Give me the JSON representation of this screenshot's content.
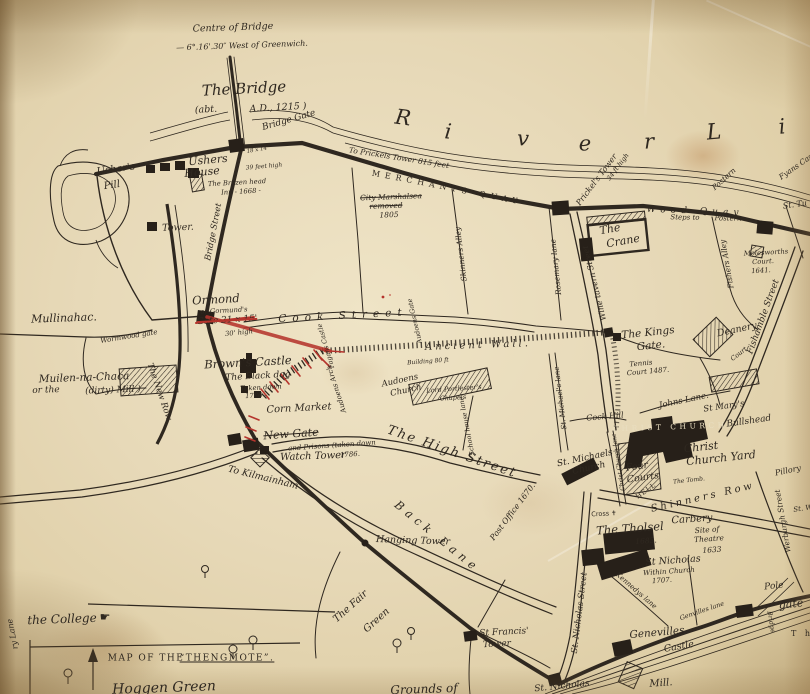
{
  "palette": {
    "paper": "#e7d9b8",
    "ink": "#2f2820",
    "red": "#b5342c",
    "knockout": "#e9dec0"
  },
  "labels": [
    {
      "n": "centre-of-bridge-note",
      "t": "Centre of Bridge",
      "x": 233,
      "y": 28,
      "s": 9.5,
      "r": -2
    },
    {
      "n": "greenwich-note",
      "t": "— 6°.16'.30″ West of Greenwich.",
      "x": 242,
      "y": 46,
      "s": 8,
      "r": -2
    },
    {
      "n": "the-bridge",
      "t": "The Bridge",
      "x": 244,
      "y": 89,
      "s": 15,
      "r": -3
    },
    {
      "n": "bridge-date-left",
      "t": "(abt.",
      "x": 206,
      "y": 110,
      "s": 9.5,
      "r": -3
    },
    {
      "n": "bridge-date-right",
      "t": "A.D., 1215 )",
      "x": 278,
      "y": 108,
      "s": 9.5,
      "r": -3
    },
    {
      "n": "bridge-gate",
      "t": "Bridge Gate",
      "x": 289,
      "y": 121,
      "s": 9,
      "r": -16
    },
    {
      "n": "bridge-gate-size",
      "t": "18 x 14",
      "x": 257,
      "y": 151,
      "s": 5.5,
      "r": -10
    },
    {
      "n": "bridge-gate-height",
      "t": "39 feet high",
      "x": 264,
      "y": 167,
      "s": 6,
      "r": -5
    },
    {
      "n": "river-letter-1",
      "t": "R",
      "x": 403,
      "y": 118,
      "s": 21,
      "r": 8
    },
    {
      "n": "river-letter-2",
      "t": "i",
      "x": 448,
      "y": 132,
      "s": 21,
      "r": 6
    },
    {
      "n": "river-letter-3",
      "t": "v",
      "x": 523,
      "y": 139,
      "s": 21,
      "r": 3
    },
    {
      "n": "river-letter-4",
      "t": "e",
      "x": 585,
      "y": 144,
      "s": 21,
      "r": 0
    },
    {
      "n": "river-letter-5",
      "t": "r",
      "x": 649,
      "y": 142,
      "s": 21,
      "r": -2
    },
    {
      "n": "river-letter-6",
      "t": "L",
      "x": 714,
      "y": 133,
      "s": 22,
      "r": -5
    },
    {
      "n": "river-letter-7",
      "t": "i",
      "x": 782,
      "y": 127,
      "s": 21,
      "r": -6
    },
    {
      "n": "to-prickels-tower-note",
      "t": "To Prickels Tower 815 feet",
      "x": 399,
      "y": 158,
      "s": 7.5,
      "r": 9
    },
    {
      "n": "merchants-quay",
      "t": "MERCHANTS QUAY",
      "x": 447,
      "y": 188,
      "s": 8,
      "r": 11,
      "ls": 5,
      "cls": "caps"
    },
    {
      "n": "city-marshalsea-1",
      "t": "City Marshalsea",
      "x": 391,
      "y": 197,
      "s": 7.5,
      "r": -2,
      "td": "strike"
    },
    {
      "n": "city-marshalsea-2",
      "t": "removed",
      "x": 386,
      "y": 206,
      "s": 7.5,
      "r": -2,
      "td": "strike"
    },
    {
      "n": "city-marshalsea-3",
      "t": "1805",
      "x": 389,
      "y": 215,
      "s": 7.5,
      "r": -2
    },
    {
      "n": "prickels-tower",
      "t": "Prickel's Tower",
      "x": 597,
      "y": 180,
      "s": 8,
      "r": -53
    },
    {
      "n": "prickels-tower-height",
      "t": "34 ft high",
      "x": 618,
      "y": 167,
      "s": 6.5,
      "r": -53
    },
    {
      "n": "postern-northeast",
      "t": "Postern",
      "x": 724,
      "y": 179,
      "s": 7.5,
      "r": -42
    },
    {
      "n": "fyans-castle",
      "t": "Fyans Cast",
      "x": 797,
      "y": 166,
      "s": 7.5,
      "r": -35
    },
    {
      "n": "wood-quay",
      "t": "Wood Quay",
      "x": 695,
      "y": 212,
      "s": 9,
      "r": 2,
      "ls": 5
    },
    {
      "n": "steps-to-postern-1",
      "t": "Steps to",
      "x": 685,
      "y": 218,
      "s": 7,
      "r": 1
    },
    {
      "n": "steps-to-postern-2",
      "t": "Postern",
      "x": 728,
      "y": 219,
      "s": 7,
      "r": 1
    },
    {
      "n": "st-tullocks-fragment",
      "t": "St. Tu",
      "x": 795,
      "y": 205,
      "s": 8,
      "r": -8
    },
    {
      "n": "the-crane-1",
      "t": "The",
      "x": 610,
      "y": 229,
      "s": 11,
      "r": -10
    },
    {
      "n": "the-crane-2",
      "t": "Crane",
      "x": 623,
      "y": 241,
      "s": 11,
      "r": -10
    },
    {
      "n": "molesworths-court-1",
      "t": "Molesworths",
      "x": 766,
      "y": 253,
      "s": 6.8,
      "r": -3
    },
    {
      "n": "molesworths-court-2",
      "t": "Court.",
      "x": 763,
      "y": 262,
      "s": 6.8,
      "r": -3
    },
    {
      "n": "molesworths-court-3",
      "t": "1641.",
      "x": 761,
      "y": 271,
      "s": 6.8,
      "r": -3
    },
    {
      "n": "fishers-alley",
      "t": "Fishers Alley",
      "x": 727,
      "y": 264,
      "s": 7.5,
      "r": -100
    },
    {
      "n": "wine-tavern-street",
      "t": "Wine tavern Street",
      "x": 595,
      "y": 283,
      "s": 8,
      "r": -104
    },
    {
      "n": "rosemary-lane",
      "t": "Rosemary lane",
      "x": 556,
      "y": 267,
      "s": 7.5,
      "r": -96
    },
    {
      "n": "skinners-alley",
      "t": "Skinners Alley",
      "x": 461,
      "y": 254,
      "s": 7.5,
      "r": -97
    },
    {
      "n": "ushers-pill-1",
      "t": "Usher's",
      "x": 116,
      "y": 170,
      "s": 10,
      "r": -8
    },
    {
      "n": "ushers-pill-2",
      "t": "Pill",
      "x": 112,
      "y": 186,
      "s": 10,
      "r": -8
    },
    {
      "n": "ushers-house-1",
      "t": "Ushers",
      "x": 208,
      "y": 160,
      "s": 11,
      "r": -5
    },
    {
      "n": "ushers-house-2",
      "t": "House",
      "x": 202,
      "y": 172,
      "s": 11,
      "r": -5
    },
    {
      "n": "brazen-head-1",
      "t": "The Brazen head",
      "x": 237,
      "y": 183,
      "s": 6.8,
      "r": -3
    },
    {
      "n": "brazen-head-2",
      "t": "Inn - 1668 -",
      "x": 241,
      "y": 192,
      "s": 6.8,
      "r": -3
    },
    {
      "n": "tower",
      "t": "Tower.",
      "x": 178,
      "y": 228,
      "s": 9.5,
      "r": -2
    },
    {
      "n": "bridge-street",
      "t": "Bridge Street",
      "x": 214,
      "y": 232,
      "s": 8.5,
      "r": -79
    },
    {
      "n": "mullinahac",
      "t": "Mullinahac.",
      "x": 64,
      "y": 318,
      "s": 11,
      "r": -2
    },
    {
      "n": "wormwood-gate",
      "t": "Wormwood gate",
      "x": 129,
      "y": 337,
      "s": 7,
      "r": -9
    },
    {
      "n": "ormond-gate-1",
      "t": "Ormond",
      "x": 216,
      "y": 300,
      "s": 11.5,
      "r": -3
    },
    {
      "n": "ormond-gate-2",
      "t": "or Gormund's",
      "x": 224,
      "y": 311,
      "s": 6.8,
      "r": -3
    },
    {
      "n": "ormond-gate-3",
      "t": "Gate 21 x 15'",
      "x": 227,
      "y": 321,
      "s": 9,
      "r": -3,
      "td": "strike-red"
    },
    {
      "n": "ormond-gate-4",
      "t": "30' high",
      "x": 239,
      "y": 333,
      "s": 6.8,
      "r": -6
    },
    {
      "n": "muilen-na-chaca-1",
      "t": "Muilen-na-Chaca",
      "x": 84,
      "y": 378,
      "s": 10.5,
      "r": -2
    },
    {
      "n": "muilen-na-chaca-2",
      "t": "or the",
      "x": 46,
      "y": 391,
      "s": 9,
      "r": -2
    },
    {
      "n": "muilen-na-chaca-3",
      "t": "(dirty) Mill )",
      "x": 113,
      "y": 391,
      "s": 9,
      "r": -2
    },
    {
      "n": "the-new-row",
      "t": "The New Row",
      "x": 159,
      "y": 392,
      "s": 8.5,
      "r": 71
    },
    {
      "n": "browns-castle",
      "t": "Brown's Castle",
      "x": 248,
      "y": 363,
      "s": 11.5,
      "r": -3
    },
    {
      "n": "black-dog-1",
      "t": "The Black dog",
      "x": 258,
      "y": 377,
      "s": 9,
      "r": -3
    },
    {
      "n": "black-dog-2",
      "t": "Taken down",
      "x": 261,
      "y": 388,
      "s": 6.8,
      "r": -3
    },
    {
      "n": "black-dog-3",
      "t": "1786 -",
      "x": 256,
      "y": 396,
      "s": 6.8,
      "r": -3
    },
    {
      "n": "corn-market",
      "t": "Corn Market",
      "x": 299,
      "y": 409,
      "s": 10,
      "r": -3
    },
    {
      "n": "new-gate-1",
      "t": "New Gate",
      "x": 291,
      "y": 434,
      "s": 11,
      "r": -4,
      "td": "strike"
    },
    {
      "n": "new-gate-2",
      "t": "and Prisons (taken down",
      "x": 332,
      "y": 446,
      "s": 7,
      "r": -4
    },
    {
      "n": "new-gate-3",
      "t": "1786.",
      "x": 350,
      "y": 455,
      "s": 7,
      "r": -4
    },
    {
      "n": "watch-tower",
      "t": "Watch Tower",
      "x": 313,
      "y": 457,
      "s": 10,
      "r": -2
    },
    {
      "n": "to-kilmainham",
      "t": "To Kilmainham",
      "x": 263,
      "y": 478,
      "s": 9.5,
      "r": 14
    },
    {
      "n": "cook-street",
      "t": "Cook Street",
      "x": 343,
      "y": 316,
      "s": 10.5,
      "r": -3,
      "ls": 6
    },
    {
      "n": "ancient-wall",
      "t": "Ancient Wall.",
      "x": 478,
      "y": 346,
      "s": 10,
      "r": -2,
      "ls": 3
    },
    {
      "n": "fagans-castle",
      "t": "Fagans Castle",
      "x": 326,
      "y": 346,
      "s": 6.5,
      "r": -106
    },
    {
      "n": "audoens-gate",
      "t": "Audoens Gate",
      "x": 415,
      "y": 321,
      "s": 6.5,
      "r": -103
    },
    {
      "n": "audoens-arch",
      "t": "Audoens Arch",
      "x": 337,
      "y": 389,
      "s": 7,
      "r": -108
    },
    {
      "n": "building-note",
      "t": "Building 80 ft",
      "x": 428,
      "y": 362,
      "s": 6,
      "r": -4
    },
    {
      "n": "audoens-church-1",
      "t": "Audoens",
      "x": 400,
      "y": 381,
      "s": 8.5,
      "r": -12
    },
    {
      "n": "audoens-church-2",
      "t": "Church",
      "x": 406,
      "y": 391,
      "s": 8.5,
      "r": -12
    },
    {
      "n": "portlesters-chapel-1",
      "t": "Lord Portlester's",
      "x": 454,
      "y": 389,
      "s": 6.5,
      "r": -4
    },
    {
      "n": "portlesters-chapel-2",
      "t": "Chapels",
      "x": 453,
      "y": 398,
      "s": 6.5,
      "r": -4
    },
    {
      "n": "school-house-lane",
      "t": "School house lane",
      "x": 467,
      "y": 426,
      "s": 6.5,
      "r": -101
    },
    {
      "n": "the-high-street",
      "t": "The High Street",
      "x": 452,
      "y": 452,
      "s": 13,
      "r": 19,
      "ls": 2
    },
    {
      "n": "back-lane",
      "t": "Back Lane",
      "x": 437,
      "y": 537,
      "s": 11.5,
      "r": 39,
      "ls": 5
    },
    {
      "n": "hanging-tower",
      "t": "Hanging Tower",
      "x": 413,
      "y": 541,
      "s": 9.5,
      "r": 2
    },
    {
      "n": "post-office",
      "t": "Post Office 1670.",
      "x": 513,
      "y": 512,
      "s": 8,
      "r": -53
    },
    {
      "n": "fair-green-1",
      "t": "The Fair",
      "x": 351,
      "y": 607,
      "s": 10,
      "r": -42
    },
    {
      "n": "fair-green-2",
      "t": "Green",
      "x": 377,
      "y": 621,
      "s": 10,
      "r": -42
    },
    {
      "n": "st-francis-tower-1",
      "t": "St Francis'",
      "x": 504,
      "y": 633,
      "s": 9,
      "r": -3
    },
    {
      "n": "st-francis-tower-2",
      "t": "Tower",
      "x": 497,
      "y": 645,
      "s": 9,
      "r": -3
    },
    {
      "n": "grounds-of",
      "t": "Grounds of",
      "x": 424,
      "y": 689,
      "s": 12,
      "r": -2
    },
    {
      "n": "st-nicholas-gate",
      "t": "St. Nicholas",
      "x": 562,
      "y": 687,
      "s": 9,
      "r": -6
    },
    {
      "n": "st-nicholas-street",
      "t": "St. Nicholas Street",
      "x": 580,
      "y": 613,
      "s": 8.5,
      "r": -83
    },
    {
      "n": "kennedys-lane",
      "t": "Kennedys lane",
      "x": 636,
      "y": 591,
      "s": 7,
      "r": 41
    },
    {
      "n": "st-nicholas-church-1",
      "t": "St Nicholas",
      "x": 673,
      "y": 561,
      "s": 9.5,
      "r": -4
    },
    {
      "n": "st-nicholas-church-2",
      "t": "Within Church",
      "x": 669,
      "y": 572,
      "s": 7,
      "r": -4
    },
    {
      "n": "st-nicholas-church-3",
      "t": "1707.",
      "x": 662,
      "y": 581,
      "s": 7,
      "r": -4
    },
    {
      "n": "genevilles-castle-1",
      "t": "Genevilles",
      "x": 657,
      "y": 633,
      "s": 10.5,
      "r": -5
    },
    {
      "n": "genevilles-castle-2",
      "t": "Castle",
      "x": 679,
      "y": 647,
      "s": 9.5,
      "r": -10
    },
    {
      "n": "genvilles-lane",
      "t": "Genvilles lane",
      "x": 702,
      "y": 611,
      "s": 6.5,
      "r": -19
    },
    {
      "n": "pole-gate-1",
      "t": "Pole",
      "x": 774,
      "y": 587,
      "s": 9,
      "r": -6
    },
    {
      "n": "pole-gate-2",
      "t": "gate",
      "x": 791,
      "y": 604,
      "s": 11,
      "r": -6
    },
    {
      "n": "pole-gate-bridge",
      "t": "Bridge",
      "x": 771,
      "y": 622,
      "s": 6.5,
      "r": 80
    },
    {
      "n": "t-h-fragment",
      "t": "T h",
      "x": 802,
      "y": 634,
      "s": 8,
      "r": 0,
      "ls": 3,
      "cls": "caps"
    },
    {
      "n": "mill",
      "t": "Mill.",
      "x": 661,
      "y": 684,
      "s": 10,
      "r": -4
    },
    {
      "n": "the-kings-gate-1",
      "t": "The Kings",
      "x": 648,
      "y": 333,
      "s": 10.5,
      "r": -6
    },
    {
      "n": "the-kings-gate-2",
      "t": "Gate.",
      "x": 651,
      "y": 346,
      "s": 10.5,
      "r": -6
    },
    {
      "n": "deanery",
      "t": "Deanery",
      "x": 737,
      "y": 330,
      "s": 9.5,
      "r": -12
    },
    {
      "n": "deanery-court",
      "t": "Court",
      "x": 739,
      "y": 354,
      "s": 6.5,
      "r": -38
    },
    {
      "n": "fishamble-street",
      "t": "Fishamble Street",
      "x": 764,
      "y": 317,
      "s": 9,
      "r": -70
    },
    {
      "n": "tennis-court-1",
      "t": "Tennis",
      "x": 641,
      "y": 364,
      "s": 7,
      "r": -5
    },
    {
      "n": "tennis-court-2",
      "t": "Court 1487.",
      "x": 648,
      "y": 372,
      "s": 7,
      "r": -5
    },
    {
      "n": "johns-lane",
      "t": "Johns Lane.",
      "x": 684,
      "y": 401,
      "s": 8.5,
      "r": -12
    },
    {
      "n": "st-marys",
      "t": "St Mary's",
      "x": 724,
      "y": 407,
      "s": 8.5,
      "r": -8
    },
    {
      "n": "christ-church-caps",
      "t": "CHRIST CHURCH.",
      "x": 673,
      "y": 427,
      "s": 7.5,
      "r": -2,
      "ls": 3.5,
      "cls": "caps",
      "c": "#e9dec0"
    },
    {
      "n": "bullshead",
      "t": "Bullshead",
      "x": 749,
      "y": 422,
      "s": 9,
      "r": -8
    },
    {
      "n": "christ-church-yard-1",
      "t": "Christ",
      "x": 701,
      "y": 447,
      "s": 11,
      "r": -6
    },
    {
      "n": "christ-church-yard-2",
      "t": "Church Yard",
      "x": 721,
      "y": 458,
      "s": 11,
      "r": -6
    },
    {
      "n": "the-tomb",
      "t": "The Tomb.",
      "x": 689,
      "y": 481,
      "s": 6,
      "r": -6
    },
    {
      "n": "st-michaels-church-1",
      "t": "St. Michaels",
      "x": 585,
      "y": 459,
      "s": 9,
      "r": -12
    },
    {
      "n": "st-michaels-church-2",
      "t": "Church",
      "x": 589,
      "y": 469,
      "s": 9,
      "r": -12
    },
    {
      "n": "four-courts-1",
      "t": "Four",
      "x": 637,
      "y": 467,
      "s": 9.5,
      "r": -8
    },
    {
      "n": "four-courts-2",
      "t": "Courts",
      "x": 643,
      "y": 478,
      "s": 9.5,
      "r": -8
    },
    {
      "n": "cock-hill",
      "t": "Cock Hill",
      "x": 605,
      "y": 417,
      "s": 8,
      "r": -5
    },
    {
      "n": "st-michaels-lane",
      "t": "St. Michael's lane",
      "x": 561,
      "y": 398,
      "s": 7,
      "r": -97
    },
    {
      "n": "christ-church-lane",
      "t": "Christ Church lane",
      "x": 619,
      "y": 462,
      "s": 6,
      "r": -99
    },
    {
      "n": "hell",
      "t": "HELL",
      "x": 646,
      "y": 491,
      "s": 6.5,
      "r": -35,
      "ls": 1,
      "cls": "caps"
    },
    {
      "n": "shinners-row",
      "t": "Shinners Row",
      "x": 703,
      "y": 498,
      "s": 10,
      "r": -13,
      "ls": 3
    },
    {
      "n": "cross-marker",
      "t": "Cross ✝",
      "x": 604,
      "y": 514,
      "s": 6.5,
      "r": -3,
      "cls": "glyph"
    },
    {
      "n": "pillory",
      "t": "Pillory",
      "x": 788,
      "y": 471,
      "s": 8,
      "r": -12
    },
    {
      "n": "werburgh-street",
      "t": "Werburgh Street",
      "x": 783,
      "y": 521,
      "s": 7.5,
      "r": -100
    },
    {
      "n": "st-w-fragment",
      "t": "St. W",
      "x": 803,
      "y": 509,
      "s": 7,
      "r": -8
    },
    {
      "n": "the-tholsel",
      "t": "The Tholsel",
      "x": 630,
      "y": 529,
      "s": 11.5,
      "r": -4
    },
    {
      "n": "tholsel-date",
      "t": "1683.",
      "x": 646,
      "y": 541,
      "s": 7.5,
      "r": -4
    },
    {
      "n": "carbery",
      "t": "Carbery",
      "x": 692,
      "y": 520,
      "s": 10,
      "r": -4
    },
    {
      "n": "site-of",
      "t": "Site of",
      "x": 707,
      "y": 530,
      "s": 7.5,
      "r": -4
    },
    {
      "n": "theatre",
      "t": "Theatre",
      "x": 709,
      "y": 539,
      "s": 7.5,
      "r": -4
    },
    {
      "n": "theatre-date",
      "t": "1633",
      "x": 712,
      "y": 550,
      "s": 7.5,
      "r": -4
    },
    {
      "n": "ry-lane-fragment",
      "t": "ry Lane",
      "x": 13,
      "y": 634,
      "s": 8,
      "r": -101
    },
    {
      "n": "the-college",
      "t": "the College",
      "x": 62,
      "y": 619,
      "s": 12,
      "r": -2
    },
    {
      "n": "manicule-icon",
      "t": "☛",
      "x": 105,
      "y": 617,
      "s": 12,
      "r": 0,
      "cls": "glyph"
    },
    {
      "n": "inset-title-1",
      "t": "MAP OF THE",
      "x": 146,
      "y": 659,
      "s": 9,
      "r": 0,
      "ls": 1.5,
      "cls": "caps"
    },
    {
      "n": "inset-title-2",
      "t": "“THENGMOTE”.",
      "x": 227,
      "y": 659,
      "s": 9,
      "r": 0,
      "ls": 1.5,
      "cls": "caps",
      "td": "underline"
    },
    {
      "n": "hoggen-green",
      "t": "Hoggen Green",
      "x": 164,
      "y": 688,
      "s": 14,
      "r": -2
    }
  ]
}
